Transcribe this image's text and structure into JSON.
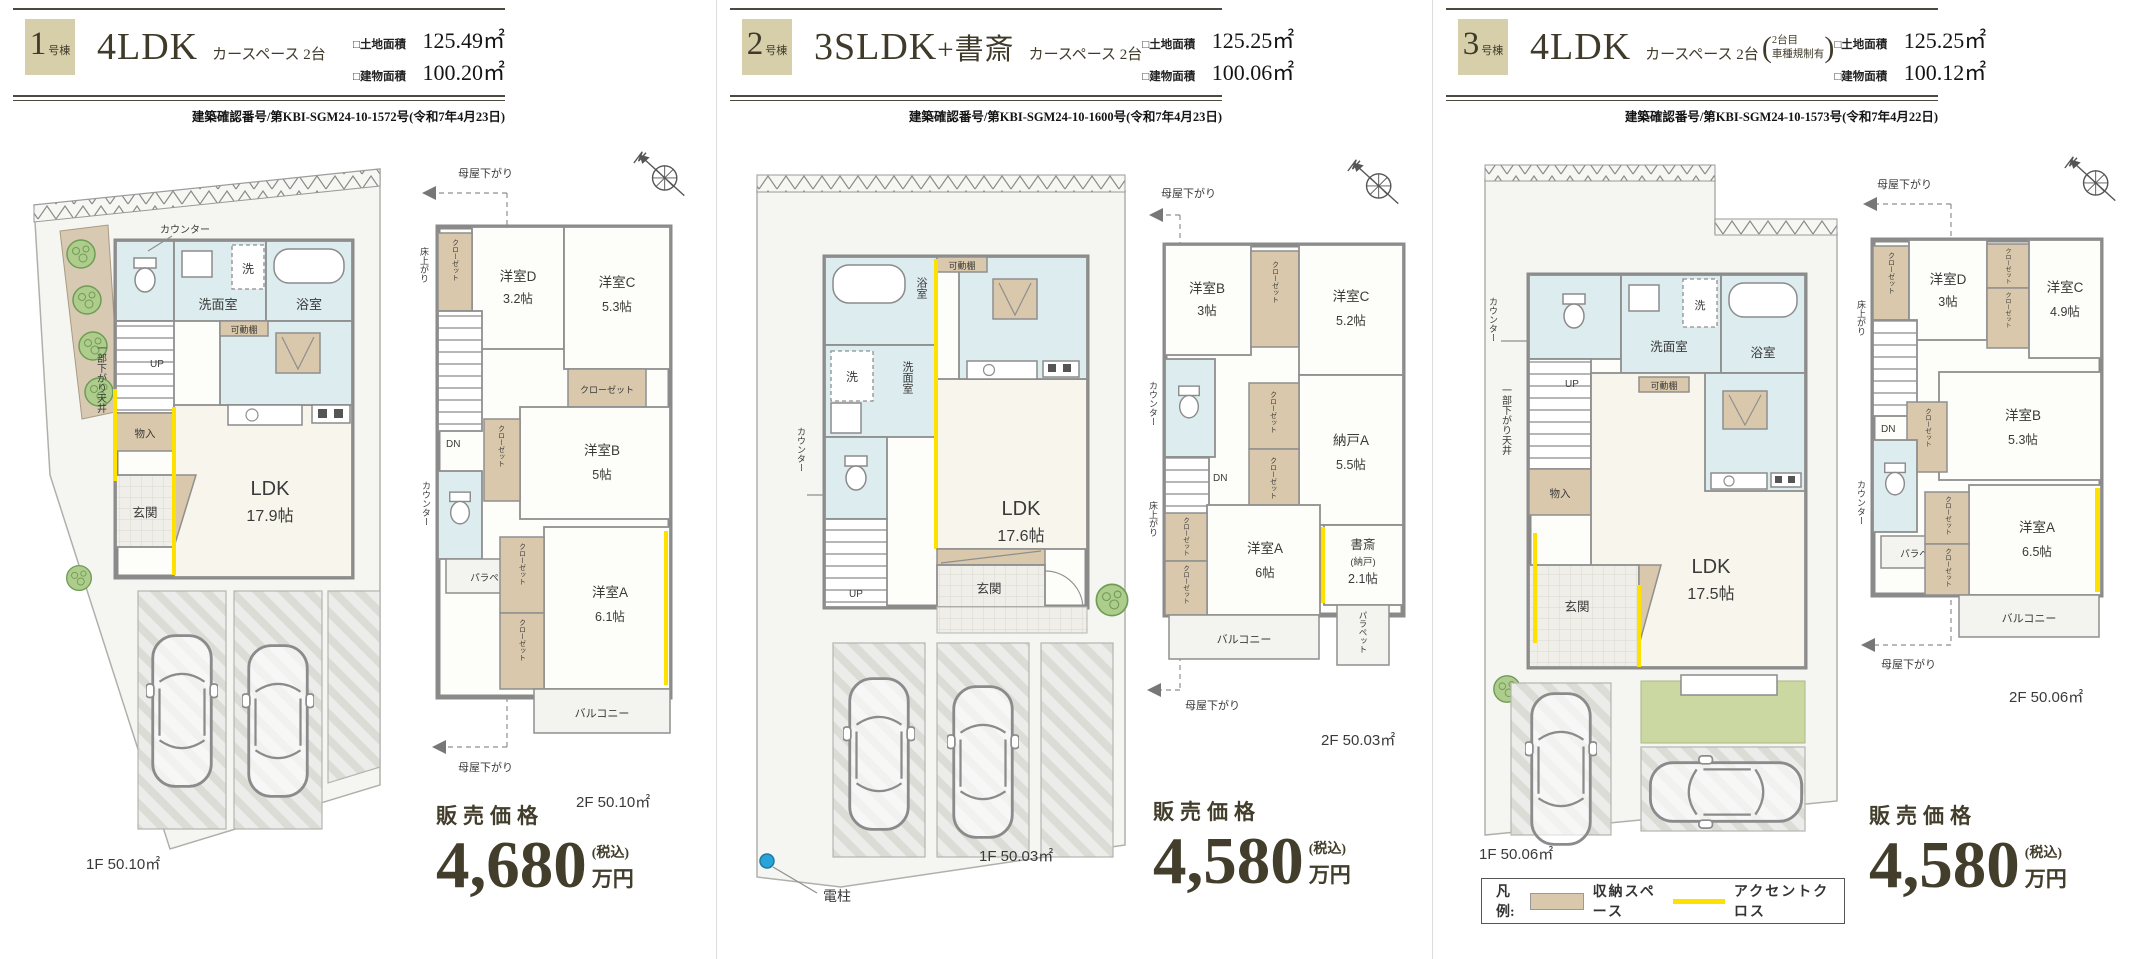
{
  "colors": {
    "header_box": "#d6cfaa",
    "text_dark": "#433e2c",
    "accent_yellow": "#ffe100",
    "storage_beige": "#d9c8ab",
    "water_blue": "#dcecef",
    "room_cream": "#f8f6ec",
    "garden_green": "#ccd8a2",
    "pole_blue": "#2aa3d8"
  },
  "common": {
    "ldk": "LDK",
    "closet": "クローゼット",
    "up": "UP",
    "dn": "DN",
    "moya": "母屋下がり",
    "yuka": "床上がり",
    "parapet": "パラペット",
    "balcony": "バルコニー",
    "counter": "カウンター",
    "kadodana": "可動棚",
    "genkan": "玄関",
    "senmen": "洗面室",
    "yokushitsu": "浴室",
    "sen": "洗",
    "monoire": "物入",
    "sagari": "一部下がり天井",
    "denchu": "電柱",
    "price_label": "販売価格",
    "tax": "(税込)",
    "man_en": "万円"
  },
  "legend": {
    "title": "凡例:",
    "storage": "収納スペース",
    "accent": "アクセントクロス"
  },
  "units": [
    {
      "no": "1",
      "no_suffix": "号棟",
      "plan": "4LDK",
      "plan_extra": "",
      "car": "カースペース 2台",
      "land_label": "□土地面積",
      "land": "125.49㎡",
      "bldg_label": "□建物面積",
      "bldg": "100.20㎡",
      "approval": "建築確認番号/第KBI-SGM24-10-1572号(令和7年4月23日)",
      "f1": "1F 50.10㎡",
      "f2": "2F 50.10㎡",
      "price": "4,680",
      "ldk_size": "17.9帖",
      "rooms": {
        "a": "洋室A",
        "a_size": "6.1帖",
        "b": "洋室B",
        "b_size": "5帖",
        "c": "洋室C",
        "c_size": "5.3帖",
        "d": "洋室D",
        "d_size": "3.2帖"
      }
    },
    {
      "no": "2",
      "no_suffix": "号棟",
      "plan": "3SLDK",
      "plan_extra": "+書斎",
      "car": "カースペース 2台",
      "land_label": "□土地面積",
      "land": "125.25㎡",
      "bldg_label": "□建物面積",
      "bldg": "100.06㎡",
      "approval": "建築確認番号/第KBI-SGM24-10-1600号(令和7年4月23日)",
      "f1": "1F 50.03㎡",
      "f2": "2F 50.03㎡",
      "price": "4,580",
      "ldk_size": "17.6帖",
      "rooms": {
        "a": "洋室A",
        "a_size": "6帖",
        "b": "洋室B",
        "b_size": "3帖",
        "c": "洋室C",
        "c_size": "5.2帖",
        "nando": "納戸A",
        "nando_size": "5.5帖",
        "shosai": "書斎",
        "shosai_sub": "(納戸)",
        "shosai_size": "2.1帖"
      }
    },
    {
      "no": "3",
      "no_suffix": "号棟",
      "plan": "4LDK",
      "plan_extra": "",
      "car": "カースペース 2台",
      "car_note_1": "2台目",
      "car_note_2": "車種規制有",
      "land_label": "□土地面積",
      "land": "125.25㎡",
      "bldg_label": "□建物面積",
      "bldg": "100.12㎡",
      "approval": "建築確認番号/第KBI-SGM24-10-1573号(令和7年4月22日)",
      "f1": "1F 50.06㎡",
      "f2": "2F 50.06㎡",
      "price": "4,580",
      "ldk_size": "17.5帖",
      "rooms": {
        "a": "洋室A",
        "a_size": "6.5帖",
        "b": "洋室B",
        "b_size": "5.3帖",
        "c": "洋室C",
        "c_size": "4.9帖",
        "d": "洋室D",
        "d_size": "3帖"
      }
    }
  ]
}
